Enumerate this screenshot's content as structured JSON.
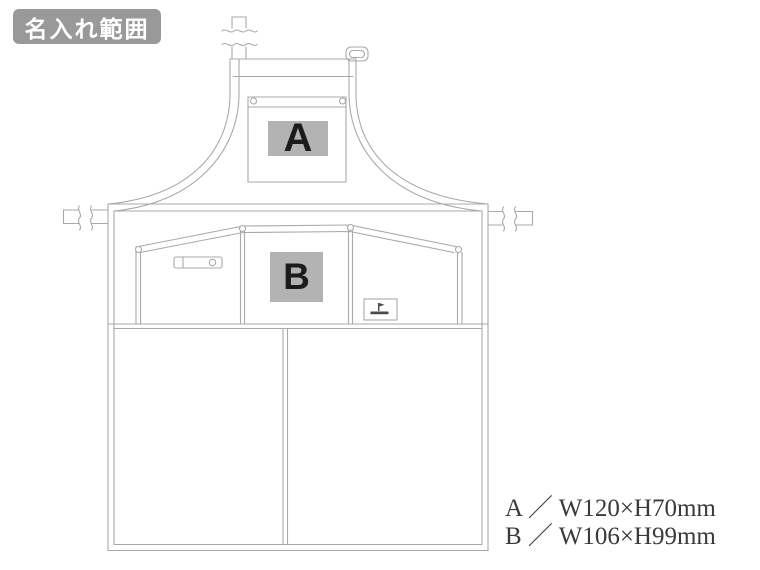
{
  "page": {
    "background": "#ffffff"
  },
  "badge": {
    "label": "名入れ範囲",
    "bg": "#999999",
    "fg": "#ffffff"
  },
  "print_areas": {
    "a": {
      "letter": "A",
      "width_mm": 120,
      "height_mm": 70,
      "fill": "#b3b3b3",
      "letter_color": "#1c1c1c"
    },
    "b": {
      "letter": "B",
      "width_mm": 106,
      "height_mm": 99,
      "fill": "#b3b3b3",
      "letter_color": "#1c1c1c"
    }
  },
  "legend": {
    "line_a": "A ／ W120×H70mm",
    "line_b": "B ／ W106×H99mm",
    "text_color": "#3a3a3a"
  },
  "diagram": {
    "type": "apron-line-drawing",
    "line_color": "#a9a9a9",
    "parts": [
      "neck-strap",
      "strap-buckle",
      "bib-panel",
      "chest-pocket",
      "waist-seam",
      "waist-tie-left",
      "waist-tie-right",
      "mid-pocket-band",
      "pen-holder-strap",
      "brand-tag",
      "bottom-pocket",
      "hem"
    ]
  }
}
